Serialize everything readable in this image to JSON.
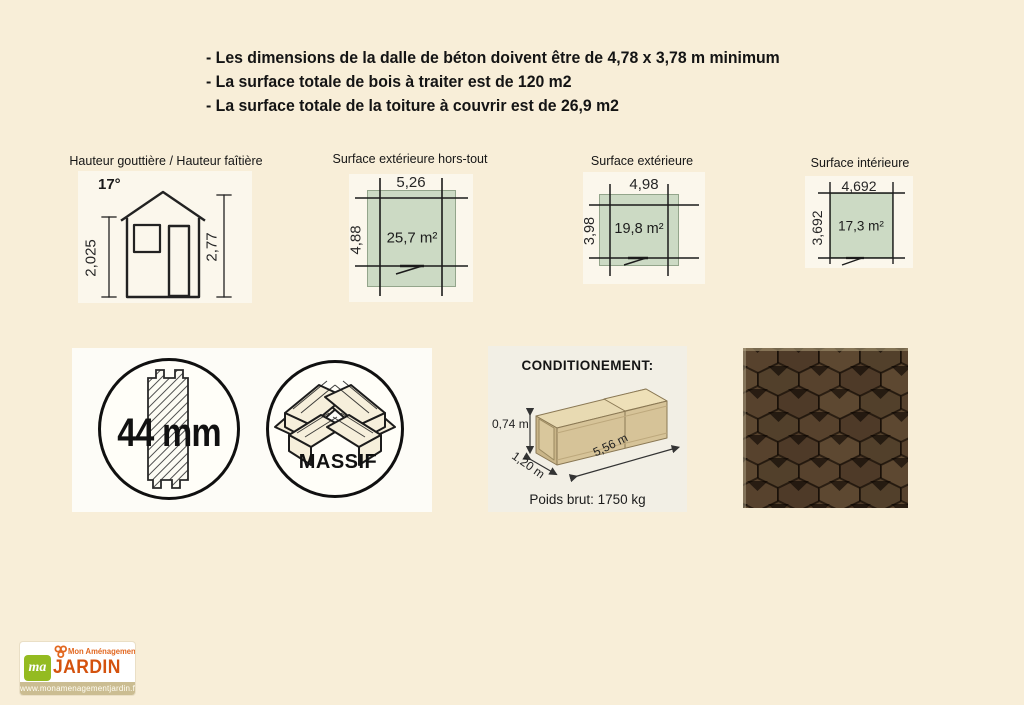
{
  "colors": {
    "page_bg": "#f8eed8",
    "panel_bg": "#fbf7ec",
    "plan_green": "#ccdac4",
    "shingle_brown": "#57422d",
    "logo_orange": "#d4520e",
    "logo_green": "#94bb21"
  },
  "notes": [
    "- Les dimensions de la dalle de béton doivent être de 4,78 x 3,78 m minimum",
    "- La surface totale de bois à traiter est de 120 m2",
    "- La surface totale de la toiture à couvrir est de 26,9 m2"
  ],
  "diagrams": [
    {
      "title": "Hauteur gouttière / Hauteur faîtière",
      "roof_angle": "17°",
      "gutter_height": "2,025",
      "ridge_height": "2,77"
    },
    {
      "title": "Surface extérieure hors-tout",
      "width": "5,26",
      "depth": "4,88",
      "area": "25,7 m²"
    },
    {
      "title": "Surface extérieure",
      "width": "4,98",
      "depth": "3,98",
      "area": "19,8 m²"
    },
    {
      "title": "Surface intérieure",
      "width": "4,692",
      "depth": "3,692",
      "area": "17,3 m²"
    }
  ],
  "features": {
    "wall_thickness": "44 mm",
    "wood_label": "MASSIF"
  },
  "packaging": {
    "title": "CONDITIONEMENT:",
    "crate_height": "0,74 m",
    "crate_width": "1,20 m",
    "crate_length": "5,56 m",
    "gross_weight": "Poids brut: 1750 kg"
  },
  "logo": {
    "monogram": "ma",
    "name_top": "Mon Aménagement",
    "name_main": "JARDIN",
    "website": "www.monamenagementjardin.fr"
  }
}
